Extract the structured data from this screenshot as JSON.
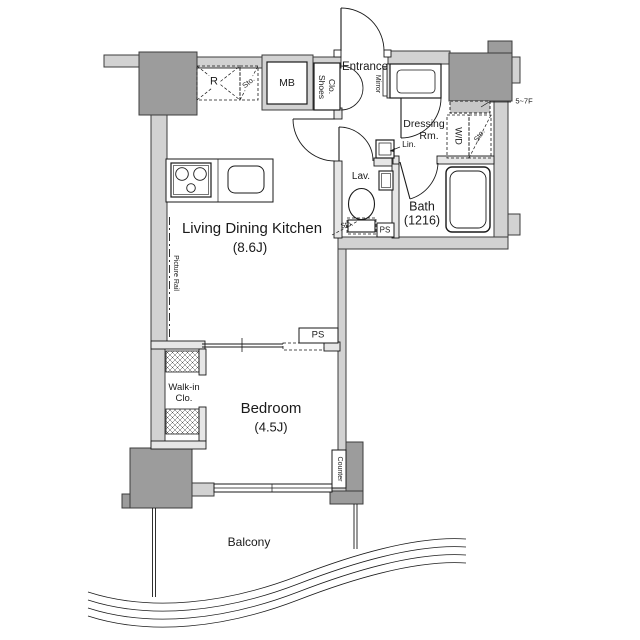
{
  "floorplan": {
    "colors": {
      "wall": "#d2d2d2",
      "pillar": "#9c9c9c",
      "line": "#1a1a1a",
      "background": "#ffffff"
    },
    "rooms": {
      "ldk": {
        "label": "Living Dining Kitchen",
        "size": "(8.6J)"
      },
      "bedroom": {
        "label": "Bedroom",
        "size": "(4.5J)"
      },
      "bath": {
        "label": "Bath",
        "size": "(1216)"
      },
      "dressing_room": {
        "line1": "Dressing",
        "line2": "Rm."
      },
      "lavatory": {
        "label": "Lav."
      },
      "entrance": {
        "label": "Entrance"
      },
      "balcony": {
        "label": "Balcony"
      },
      "walk_in_closet": {
        "line1": "Walk-in",
        "line2": "Clo."
      }
    },
    "fixtures": {
      "meter_box": "MB",
      "refrigerator": "R",
      "storage_top": "Sto.",
      "shoes_closet": {
        "line1": "Shoes",
        "line2": "Clo."
      },
      "mirror": "Mirror",
      "linen": "Lin.",
      "washer_dryer": "W/D",
      "storage_wd": "Sto.",
      "storage_toilet": "Sto.",
      "pipe_space_lavatory": "PS",
      "pipe_space_bedroom": "PS",
      "picture_rail": "Picture Rail",
      "counter": "Counter"
    },
    "annotations": {
      "floor_range": "5~7F"
    }
  }
}
